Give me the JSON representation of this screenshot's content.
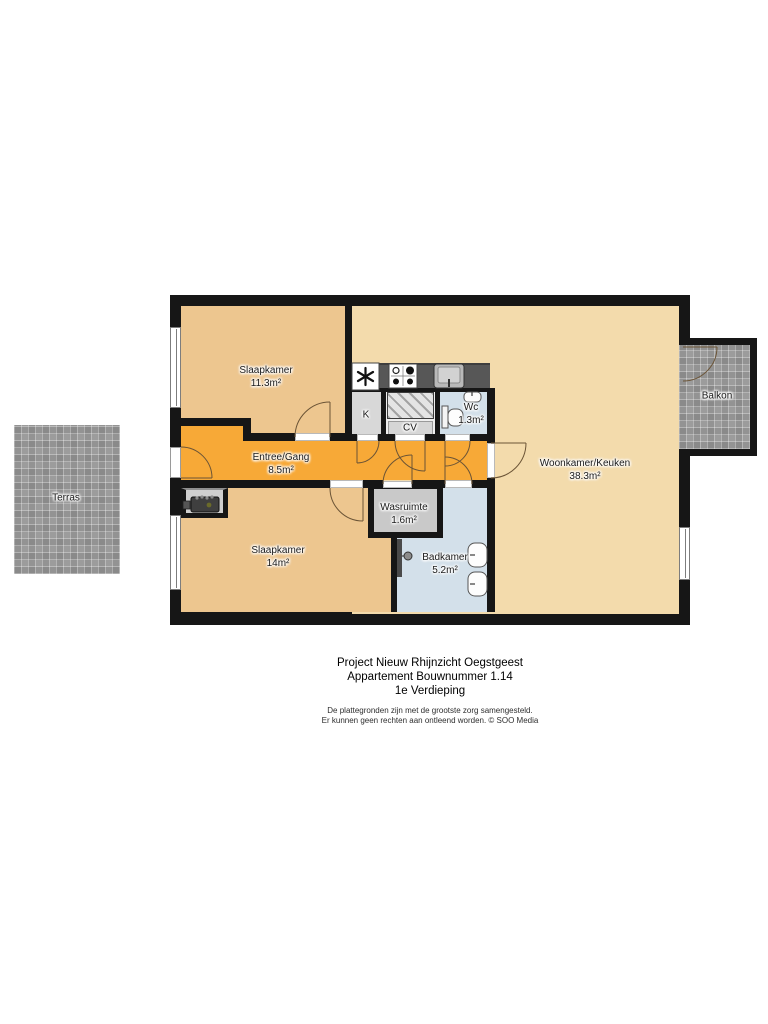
{
  "plan": {
    "rooms": {
      "slaapkamer1": {
        "label": "Slaapkamer",
        "area": "11.3m²"
      },
      "slaapkamer2": {
        "label": "Slaapkamer",
        "area": "14m²"
      },
      "entree": {
        "label": "Entree/Gang",
        "area": "8.5m²"
      },
      "woonkamer": {
        "label": "Woonkamer/Keuken",
        "area": "38.3m²"
      },
      "wasruimte": {
        "label": "Wasruimte",
        "area": "1.6m²"
      },
      "badkamer": {
        "label": "Badkamer",
        "area": "5.2m²"
      },
      "wc": {
        "label": "Wc",
        "area": "1.3m²"
      },
      "kast": {
        "label": "K"
      },
      "cv": {
        "label": "CV"
      },
      "balkon": {
        "label": "Balkon"
      },
      "terras": {
        "label": "Terras"
      }
    },
    "colors": {
      "wall": "#161616",
      "bedroom": "#EDC68F",
      "living": "#F3DBAC",
      "hall": "#F7A937",
      "bath": "#D3E0EA",
      "service_gray": "#D8D8D8",
      "counter": "#575757",
      "tile": "#9C9C9C"
    },
    "icons": [
      "fridge-icon",
      "stove-icon",
      "kitchen-sink-icon",
      "toilet-icon",
      "washbasin-icon",
      "shower-icon",
      "boiler-icon"
    ]
  },
  "footer": {
    "project": "Project Nieuw Rhijnzicht Oegstgeest",
    "apartment": "Appartement Bouwnummer 1.14",
    "floor": "1e Verdieping",
    "disclaimer1": "De plattegronden zijn met de grootste zorg samengesteld.",
    "disclaimer2": "Er kunnen geen rechten aan ontleend worden. © SOO Media"
  }
}
